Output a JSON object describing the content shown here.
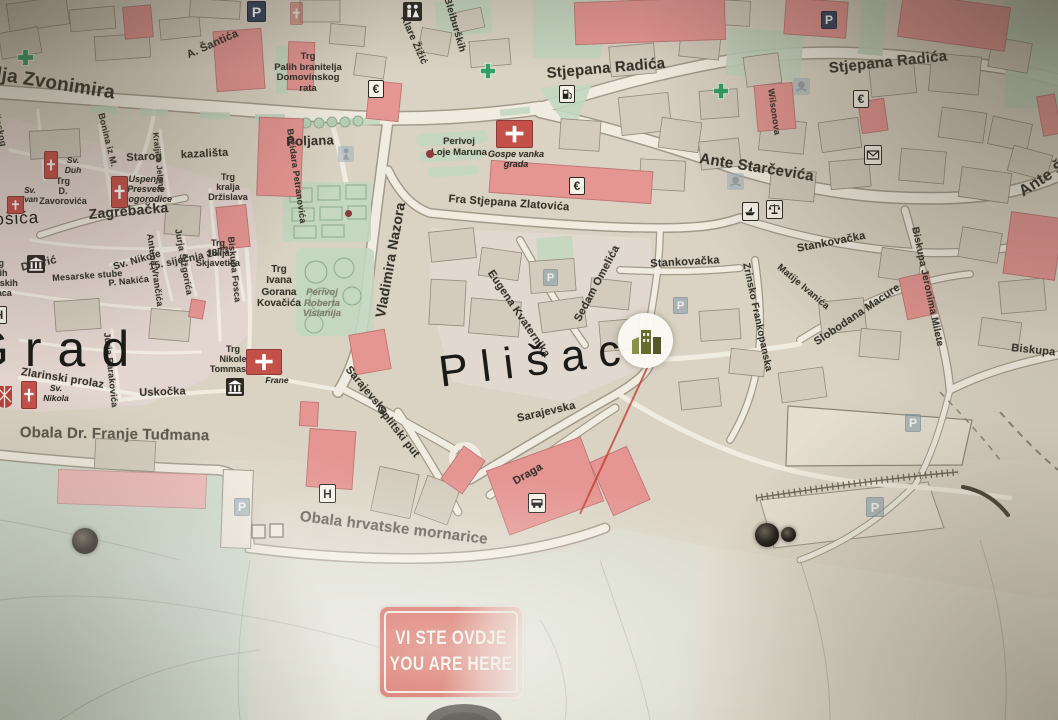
{
  "sign": {
    "line1": "VI STE OVDJE",
    "line2": "YOU ARE HERE"
  },
  "colors": {
    "sign_red": "#cb4232",
    "building_red": "#e59592",
    "park_green": "#c2d7c1",
    "sea_green": "#d5ddd0",
    "marker_olive": "#666c2f",
    "paper": "#dcd5c6",
    "leader_line_red": "#c0392b"
  },
  "labels": {
    "districts": [
      {
        "text": "Grad",
        "x": -30,
        "y": 320,
        "size": 50,
        "ls": 16,
        "rot": 0
      },
      {
        "text": "Plišac",
        "x": 436,
        "y": 348,
        "size": 44,
        "ls": 13,
        "rot": -7
      },
      {
        "text": "ošića",
        "x": -6,
        "y": 210,
        "size": 17,
        "ls": 1,
        "rot": -3
      }
    ],
    "streets": [
      {
        "text": "lja Zvonimira",
        "x": -2,
        "y": 64,
        "rot": 9,
        "size": 19
      },
      {
        "text": "A. Šantića",
        "x": 185,
        "y": 50,
        "rot": -24,
        "size": 11
      },
      {
        "text": "Klare Žižić",
        "x": 408,
        "y": 14,
        "rot": 66,
        "size": 10
      },
      {
        "text": "Bleiburških",
        "x": 452,
        "y": -4,
        "rot": 74,
        "size": 10
      },
      {
        "text": "Stjepana Radića",
        "x": 546,
        "y": 65,
        "rot": -5,
        "size": 15
      },
      {
        "text": "Stjepana Radića",
        "x": 828,
        "y": 60,
        "rot": -6,
        "size": 15
      },
      {
        "text": "Ante Starčevića",
        "x": 701,
        "y": 150,
        "rot": 9,
        "size": 15
      },
      {
        "text": "Ante Š",
        "x": 1016,
        "y": 186,
        "rot": -33,
        "size": 16
      },
      {
        "text": "Poljana",
        "x": 286,
        "y": 134,
        "rot": -2,
        "size": 13
      },
      {
        "text": "Starog  kazališta",
        "x": 126,
        "y": 152,
        "rot": -3,
        "size": 11,
        "ws": 6
      },
      {
        "text": "Fra Stjepana Zlatovića",
        "x": 449,
        "y": 193,
        "rot": 4,
        "size": 11
      },
      {
        "text": "Zagrebačka",
        "x": 88,
        "y": 206,
        "rot": -5,
        "size": 14
      },
      {
        "text": "Grgura Ninskog",
        "x": -6,
        "y": 76,
        "rot": 78,
        "size": 9
      },
      {
        "text": "Bonina iz M.",
        "x": 106,
        "y": 112,
        "rot": 76,
        "size": 9
      },
      {
        "text": "Božidara Petranovića",
        "x": 295,
        "y": 128,
        "rot": 82,
        "size": 9
      },
      {
        "text": "Kraljice Jelene",
        "x": 160,
        "y": 132,
        "rot": 84,
        "size": 8
      },
      {
        "text": "Vladimira Nazora",
        "x": 372,
        "y": 316,
        "rot": -80,
        "size": 14
      },
      {
        "text": "15. siječnja 1873",
        "x": 148,
        "y": 262,
        "rot": -12,
        "size": 10
      },
      {
        "text": "Sv. Nikole",
        "x": 112,
        "y": 262,
        "rot": -16,
        "size": 10
      },
      {
        "text": "P. Nakića",
        "x": 108,
        "y": 278,
        "rot": -6,
        "size": 9
      },
      {
        "text": "Mesarske stube",
        "x": 52,
        "y": 273,
        "rot": -4,
        "size": 9
      },
      {
        "text": "Dobrić",
        "x": 20,
        "y": 262,
        "rot": -13,
        "size": 11
      },
      {
        "text": "Jurja Šižgorića",
        "x": 183,
        "y": 228,
        "rot": 80,
        "size": 9
      },
      {
        "text": "Antuna Vrančića",
        "x": 155,
        "y": 233,
        "rot": 82,
        "size": 9
      },
      {
        "text": "Biskupa Fosca",
        "x": 236,
        "y": 236,
        "rot": 84,
        "size": 9
      },
      {
        "text": "Zlarinski prolaz",
        "x": 22,
        "y": 366,
        "rot": 9,
        "size": 11
      },
      {
        "text": "Jurja Barakovića",
        "x": 112,
        "y": 332,
        "rot": 84,
        "size": 9
      },
      {
        "text": "Uskočka",
        "x": 139,
        "y": 387,
        "rot": -2,
        "size": 11
      },
      {
        "text": "Obala Dr. Franje Tuđmana",
        "x": 20,
        "y": 424,
        "rot": 1,
        "size": 15,
        "cls": "faded2"
      },
      {
        "text": "Obala hrvatske mornarice",
        "x": 301,
        "y": 508,
        "rot": 7,
        "size": 15,
        "cls": "faded2"
      },
      {
        "text": "Sarajevska",
        "x": 352,
        "y": 364,
        "rot": 50,
        "size": 11
      },
      {
        "text": "Splitski put",
        "x": 384,
        "y": 404,
        "rot": 52,
        "size": 11
      },
      {
        "text": "Sarajevska",
        "x": 516,
        "y": 413,
        "rot": -13,
        "size": 11
      },
      {
        "text": "Draga",
        "x": 511,
        "y": 477,
        "rot": -30,
        "size": 11
      },
      {
        "text": "Eugena Kvaternika",
        "x": 495,
        "y": 268,
        "rot": 56,
        "size": 11
      },
      {
        "text": "Sedam Omelića",
        "x": 572,
        "y": 318,
        "rot": -62,
        "size": 11
      },
      {
        "text": "Stankovačka",
        "x": 650,
        "y": 258,
        "rot": -3,
        "size": 11
      },
      {
        "text": "Stankovačka",
        "x": 796,
        "y": 243,
        "rot": -11,
        "size": 11
      },
      {
        "text": "Zrinsko Frankopanska",
        "x": 751,
        "y": 262,
        "rot": 78,
        "size": 10
      },
      {
        "text": "Matije Ivanića",
        "x": 782,
        "y": 262,
        "rot": 40,
        "size": 9.5
      },
      {
        "text": "Slobodana Macure",
        "x": 812,
        "y": 338,
        "rot": -34,
        "size": 11
      },
      {
        "text": "Biskupa Jeronima Milete",
        "x": 920,
        "y": 226,
        "rot": 78,
        "size": 10
      },
      {
        "text": "Biskupa Je",
        "x": 1012,
        "y": 342,
        "rot": 6,
        "size": 11
      },
      {
        "text": "Wilsonova",
        "x": 776,
        "y": 88,
        "rot": 82,
        "size": 9
      }
    ],
    "places": [
      {
        "text": "Trg\nPalih branitelja\nDomovinskog\nrata",
        "x": 272,
        "y": 52,
        "w": 72,
        "size": 9.5
      },
      {
        "text": "Trg\nkralja\nDržislava",
        "x": 200,
        "y": 172,
        "w": 56,
        "size": 9
      },
      {
        "text": "Trg\nD. Zavorovića",
        "x": 34,
        "y": 176,
        "w": 58,
        "size": 9
      },
      {
        "text": "Sv.\nDuh",
        "x": 58,
        "y": 156,
        "w": 30,
        "size": 8.5,
        "cls": "it"
      },
      {
        "text": "Uspenja\nPresvete\nBogorodice",
        "x": 122,
        "y": 174,
        "w": 48,
        "size": 9,
        "cls": "it"
      },
      {
        "text": "Sv.\nIvan",
        "x": 14,
        "y": 186,
        "w": 32,
        "size": 8,
        "cls": "it"
      },
      {
        "text": "Trg\nJulija\nSkjavetića",
        "x": 193,
        "y": 238,
        "w": 50,
        "size": 9
      },
      {
        "text": "Trg\nIvana\nGorana\nKovačića",
        "x": 250,
        "y": 264,
        "w": 58,
        "size": 10
      },
      {
        "text": "Perivoj\nRoberta\nVisianija",
        "x": 296,
        "y": 288,
        "w": 52,
        "size": 9.5,
        "cls": "fadedplc"
      },
      {
        "text": "Trg\nNikole\nTommasea",
        "x": 205,
        "y": 344,
        "w": 56,
        "size": 9
      },
      {
        "text": "Sv.\nFrane",
        "x": 256,
        "y": 366,
        "w": 42,
        "size": 8.5,
        "cls": "it"
      },
      {
        "text": "Sv.\nNikola",
        "x": 34,
        "y": 384,
        "w": 44,
        "size": 8.5,
        "cls": "it"
      },
      {
        "text": "Perivoj\nLoje Maruna",
        "x": 430,
        "y": 137,
        "w": 58,
        "size": 9.5
      },
      {
        "text": "Gospe vanka\ngrada",
        "x": 486,
        "y": 149,
        "w": 60,
        "size": 9,
        "cls": "it"
      },
      {
        "text": "Trg\npalih\nšibenskih\nboraca",
        "x": -34,
        "y": 258,
        "w": 62,
        "size": 9
      }
    ]
  },
  "icons": [
    {
      "type": "parking",
      "x": 247,
      "y": 2,
      "s": 19
    },
    {
      "type": "parking",
      "x": 821,
      "y": 12,
      "s": 16
    },
    {
      "type": "parking-faded",
      "x": 543,
      "y": 270,
      "s": 15
    },
    {
      "type": "parking-faded",
      "x": 673,
      "y": 298,
      "s": 15
    },
    {
      "type": "parking-faded",
      "x": 905,
      "y": 415,
      "s": 16
    },
    {
      "type": "parking-faded",
      "x": 866,
      "y": 498,
      "s": 18
    },
    {
      "type": "parking-faded",
      "x": 234,
      "y": 499,
      "s": 16
    },
    {
      "type": "wc",
      "x": 403,
      "y": 2,
      "s": 19
    },
    {
      "type": "pharmacy",
      "x": 16,
      "y": 48,
      "s": 19
    },
    {
      "type": "pharmacy",
      "x": 479,
      "y": 62,
      "s": 18
    },
    {
      "type": "pharmacy",
      "x": 712,
      "y": 82,
      "s": 18
    },
    {
      "type": "currency",
      "x": 368,
      "y": 81,
      "s": 16
    },
    {
      "type": "currency",
      "x": 569,
      "y": 178,
      "s": 16
    },
    {
      "type": "currency",
      "x": 853,
      "y": 91,
      "s": 16
    },
    {
      "type": "fuel",
      "x": 559,
      "y": 86,
      "s": 16
    },
    {
      "type": "mail",
      "x": 864,
      "y": 146,
      "s": 18
    },
    {
      "type": "boat",
      "x": 742,
      "y": 203,
      "s": 17
    },
    {
      "type": "scales",
      "x": 766,
      "y": 201,
      "s": 17
    },
    {
      "type": "bus",
      "x": 528,
      "y": 494,
      "s": 18
    },
    {
      "type": "hospital",
      "x": 319,
      "y": 485,
      "s": 17
    },
    {
      "type": "hospital",
      "x": -9,
      "y": 307,
      "s": 16
    },
    {
      "type": "museum",
      "x": 27,
      "y": 255,
      "s": 18
    },
    {
      "type": "museum",
      "x": 226,
      "y": 378,
      "s": 18
    },
    {
      "type": "church",
      "x": 44,
      "y": 152,
      "w": 14,
      "h": 26
    },
    {
      "type": "church",
      "x": 111,
      "y": 177,
      "w": 17,
      "h": 30
    },
    {
      "type": "church",
      "x": 7,
      "y": 197,
      "w": 17,
      "h": 16
    },
    {
      "type": "church",
      "x": 21,
      "y": 382,
      "w": 16,
      "h": 26
    },
    {
      "type": "church-wide",
      "x": 246,
      "y": 350,
      "w": 36,
      "h": 24
    },
    {
      "type": "church-wide",
      "x": 496,
      "y": 121,
      "w": 37,
      "h": 26
    },
    {
      "type": "church-faded",
      "x": 290,
      "y": 3,
      "w": 13,
      "h": 21
    },
    {
      "type": "shield",
      "x": -3,
      "y": 386,
      "w": 15,
      "h": 26
    },
    {
      "type": "monument-faded",
      "x": 338,
      "y": 146,
      "s": 16
    },
    {
      "type": "fountain-faded",
      "x": 793,
      "y": 78,
      "s": 17
    },
    {
      "type": "fountain-faded",
      "x": 727,
      "y": 173,
      "s": 17
    },
    {
      "type": "dot-red",
      "x": 426,
      "y": 150,
      "s": 8
    },
    {
      "type": "dot-red",
      "x": 345,
      "y": 210,
      "s": 7
    },
    {
      "type": "screw",
      "x": 72,
      "y": 528,
      "s": 26
    },
    {
      "type": "screw",
      "x": 755,
      "y": 523,
      "s": 24
    },
    {
      "type": "screw",
      "x": 781,
      "y": 527,
      "s": 15
    }
  ]
}
